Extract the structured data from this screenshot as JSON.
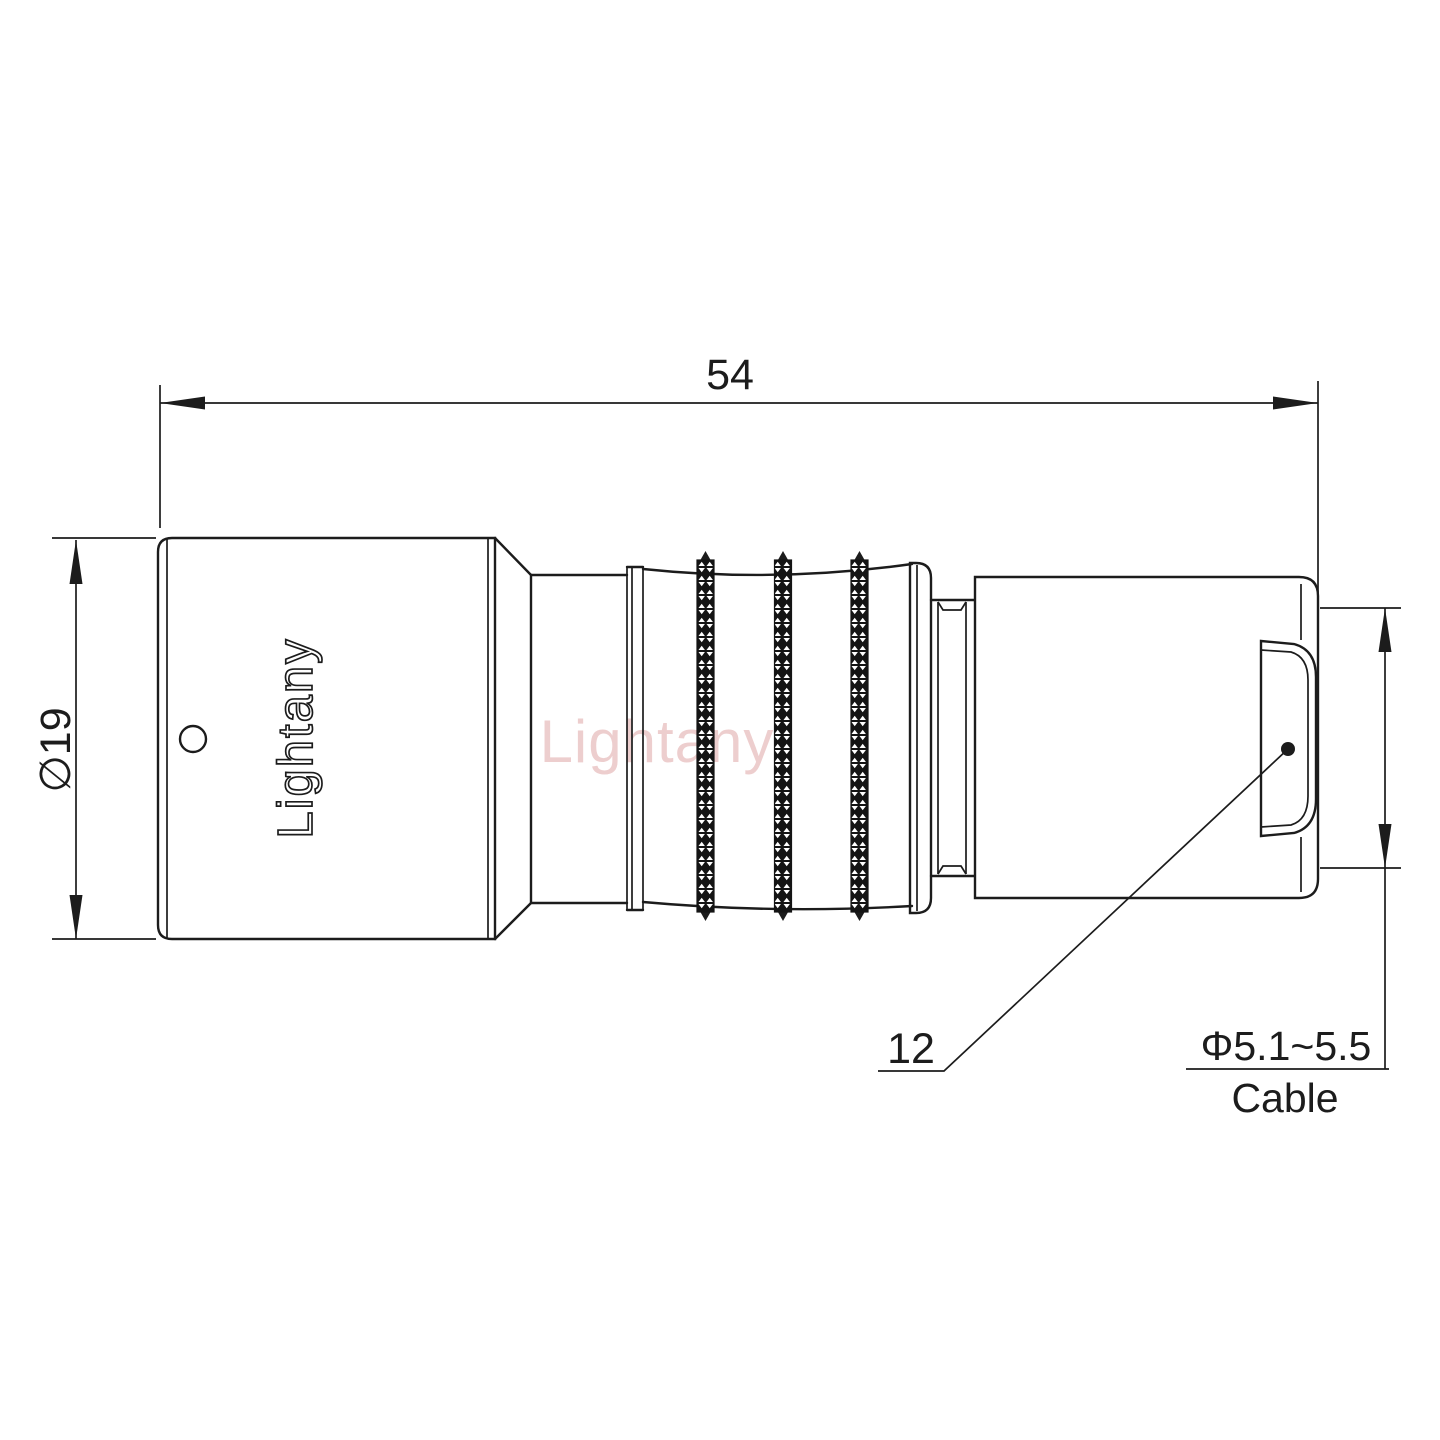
{
  "labels": {
    "overall_length": "54",
    "front_diameter": "∅19",
    "rear_leader": "12",
    "cable_diameter_range": "Φ5.1~5.5",
    "cable_word": "Cable"
  },
  "branding": {
    "body_logo": "Lightany",
    "watermark": "Lightany"
  },
  "colors": {
    "line": "#1c1c1c",
    "watermark": "#c75f5f",
    "background": "#ffffff"
  }
}
